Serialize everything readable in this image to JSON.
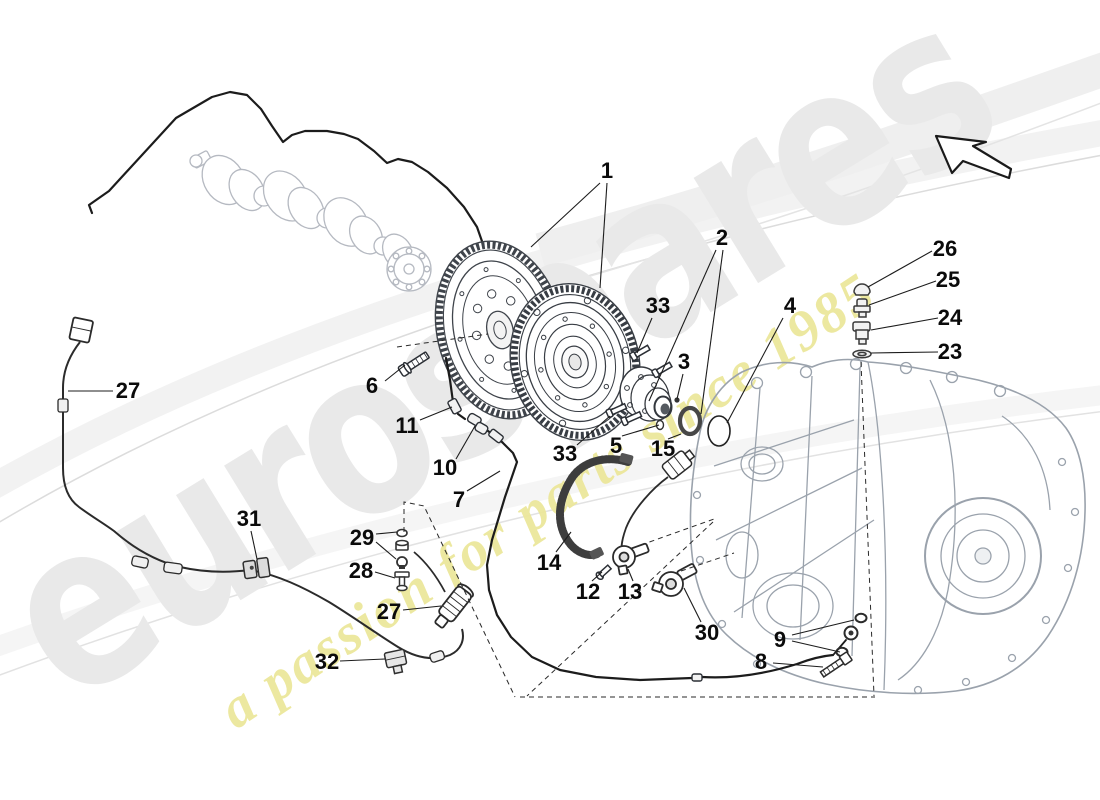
{
  "watermark": {
    "brand": "eurospares",
    "tagline": "a passion for parts since 1985",
    "brand_color": "#e9e9e9",
    "tagline_color": "#ece злоба"
  },
  "diagram": {
    "ink_color": "#1c1c1c",
    "machine_color": "#9aa2ac",
    "crank_color": "#b5b9c1",
    "part_labels": [
      {
        "text": "1",
        "x": 607,
        "y": 171
      },
      {
        "text": "2",
        "x": 722,
        "y": 238
      },
      {
        "text": "33",
        "x": 658,
        "y": 306,
        "dup": "a"
      },
      {
        "text": "3",
        "x": 684,
        "y": 362
      },
      {
        "text": "4",
        "x": 790,
        "y": 306
      },
      {
        "text": "6",
        "x": 372,
        "y": 386
      },
      {
        "text": "11",
        "x": 407,
        "y": 426
      },
      {
        "text": "10",
        "x": 445,
        "y": 468
      },
      {
        "text": "33",
        "x": 565,
        "y": 454,
        "dup": "b"
      },
      {
        "text": "5",
        "x": 616,
        "y": 446
      },
      {
        "text": "15",
        "x": 663,
        "y": 449
      },
      {
        "text": "7",
        "x": 459,
        "y": 500
      },
      {
        "text": "27",
        "x": 128,
        "y": 391,
        "dup": "a"
      },
      {
        "text": "31",
        "x": 249,
        "y": 519
      },
      {
        "text": "29",
        "x": 362,
        "y": 538
      },
      {
        "text": "28",
        "x": 361,
        "y": 571
      },
      {
        "text": "27",
        "x": 389,
        "y": 612,
        "dup": "b"
      },
      {
        "text": "32",
        "x": 327,
        "y": 662
      },
      {
        "text": "14",
        "x": 549,
        "y": 563
      },
      {
        "text": "12",
        "x": 588,
        "y": 592
      },
      {
        "text": "13",
        "x": 630,
        "y": 592
      },
      {
        "text": "30",
        "x": 707,
        "y": 633
      },
      {
        "text": "9",
        "x": 780,
        "y": 640
      },
      {
        "text": "8",
        "x": 761,
        "y": 662
      },
      {
        "text": "26",
        "x": 945,
        "y": 249
      },
      {
        "text": "25",
        "x": 948,
        "y": 280
      },
      {
        "text": "24",
        "x": 950,
        "y": 318
      },
      {
        "text": "23",
        "x": 950,
        "y": 352
      }
    ]
  }
}
